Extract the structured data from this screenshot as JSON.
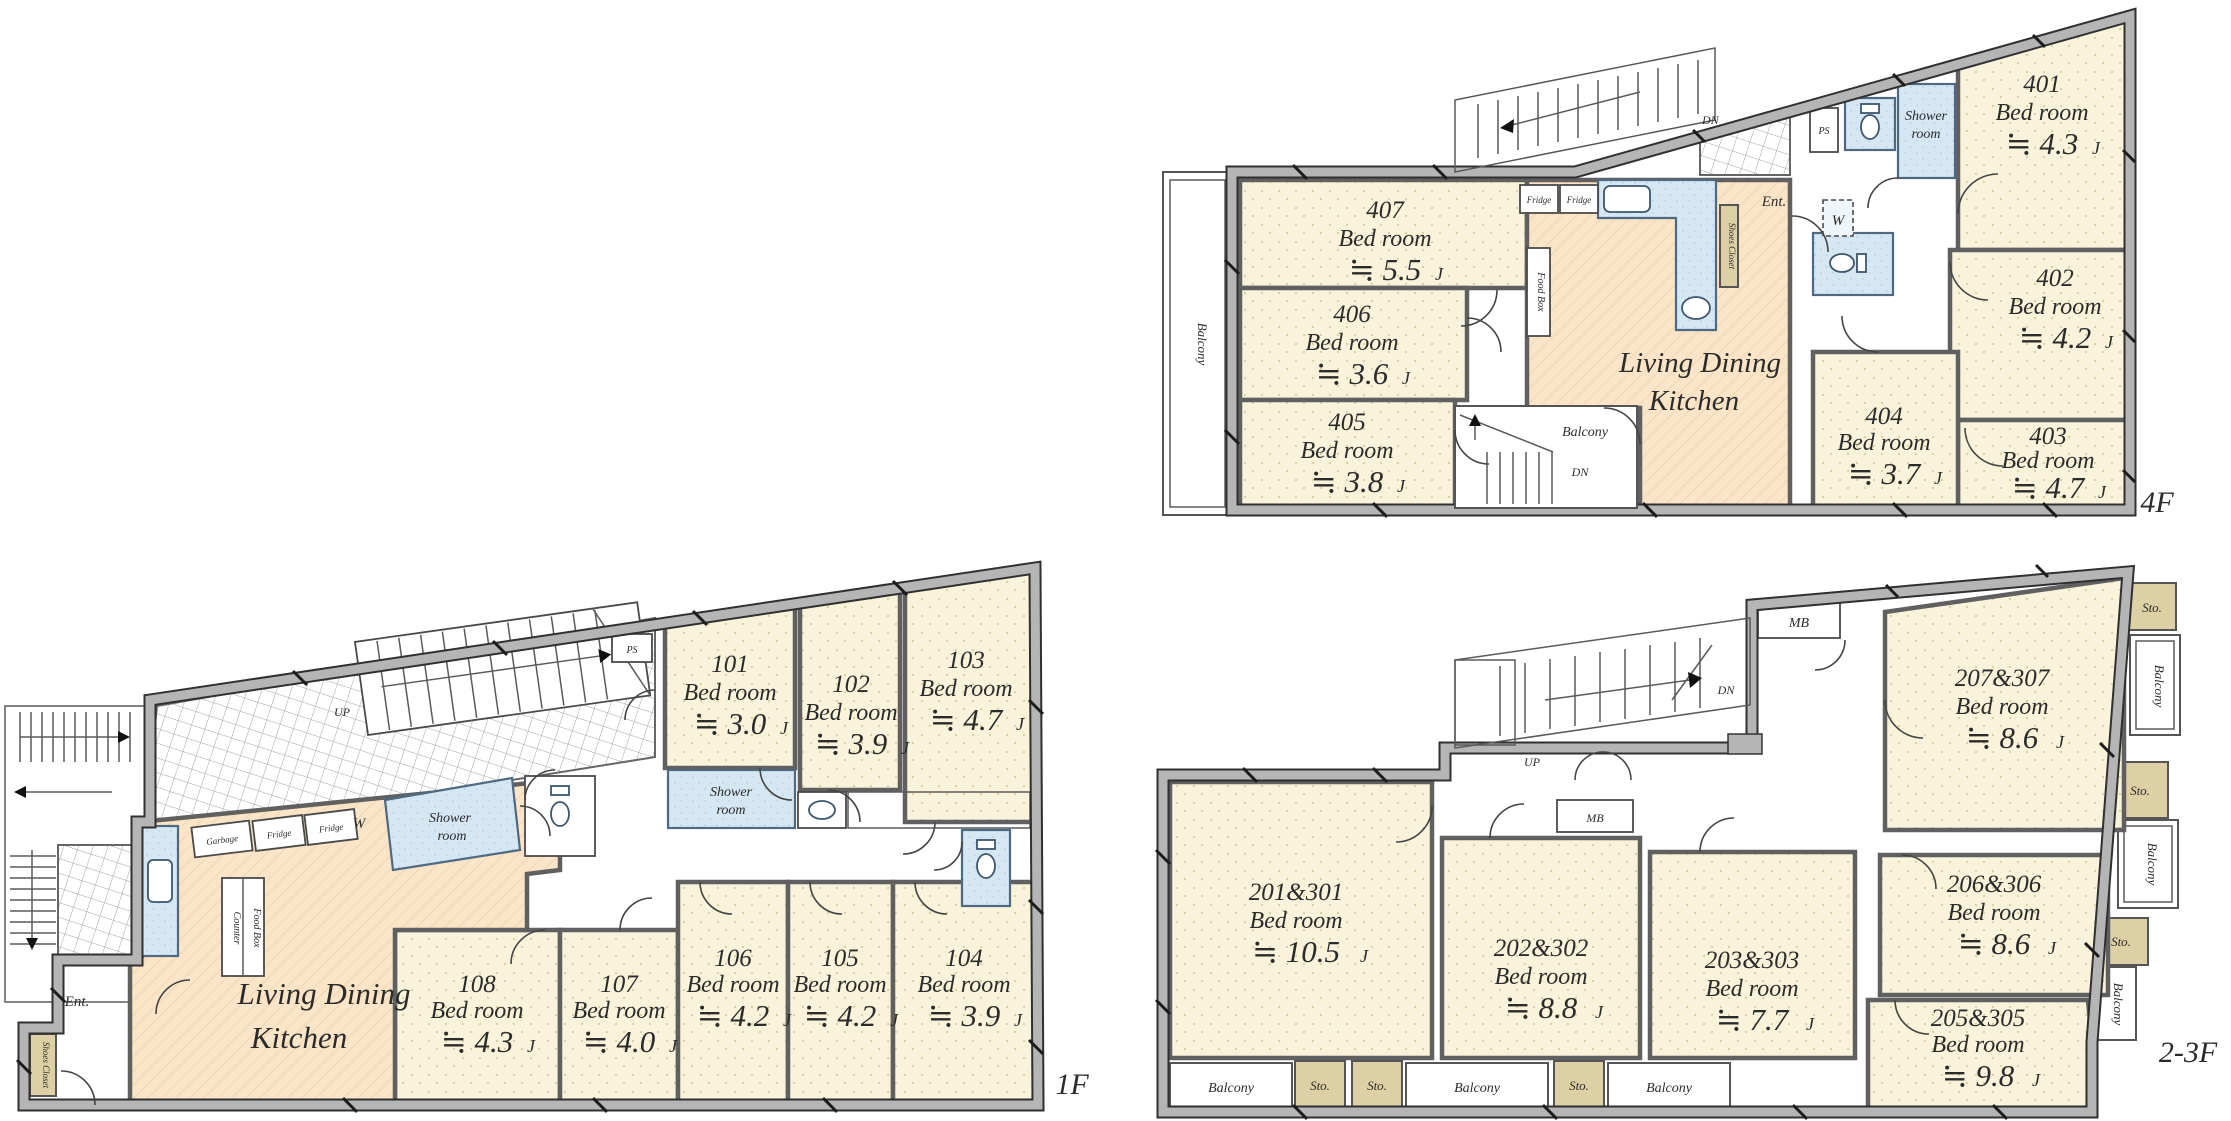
{
  "labels": {
    "balcony": "Balcony",
    "sto": "Sto.",
    "ent": "Ent.",
    "shower": "Shower",
    "room": "room",
    "living_dining": "Living Dining",
    "kitchen": "Kitchen",
    "up": "UP",
    "dn": "DN",
    "ps": "PS",
    "w": "W",
    "mb": "MB",
    "fridge": "Fridge",
    "garbage": "Garbage",
    "counter": "Counter",
    "food_box": "Food Box",
    "shoes_closet": "Shoes Closet"
  },
  "floors": {
    "f1": {
      "name": "1F",
      "rooms": [
        {
          "no": "101",
          "type": "Bed room",
          "area": "≒ 3.0",
          "unit": "J"
        },
        {
          "no": "102",
          "type": "Bed room",
          "area": "≒ 3.9",
          "unit": "J"
        },
        {
          "no": "103",
          "type": "Bed room",
          "area": "≒ 4.7",
          "unit": "J"
        },
        {
          "no": "104",
          "type": "Bed room",
          "area": "≒ 3.9",
          "unit": "J"
        },
        {
          "no": "105",
          "type": "Bed room",
          "area": "≒ 4.2",
          "unit": "J"
        },
        {
          "no": "106",
          "type": "Bed room",
          "area": "≒ 4.2",
          "unit": "J"
        },
        {
          "no": "107",
          "type": "Bed room",
          "area": "≒ 4.0",
          "unit": "J"
        },
        {
          "no": "108",
          "type": "Bed room",
          "area": "≒ 4.3",
          "unit": "J"
        }
      ]
    },
    "f23": {
      "name": "2-3F",
      "rooms": [
        {
          "no": "201&301",
          "type": "Bed room",
          "area": "≒ 10.5",
          "unit": "J"
        },
        {
          "no": "202&302",
          "type": "Bed room",
          "area": "≒ 8.8",
          "unit": "J"
        },
        {
          "no": "203&303",
          "type": "Bed room",
          "area": "≒ 7.7",
          "unit": "J"
        },
        {
          "no": "205&305",
          "type": "Bed room",
          "area": "≒ 9.8",
          "unit": "J"
        },
        {
          "no": "206&306",
          "type": "Bed room",
          "area": "≒ 8.6",
          "unit": "J"
        },
        {
          "no": "207&307",
          "type": "Bed room",
          "area": "≒ 8.6",
          "unit": "J"
        }
      ]
    },
    "f4": {
      "name": "4F",
      "rooms": [
        {
          "no": "401",
          "type": "Bed room",
          "area": "≒ 4.3",
          "unit": "J"
        },
        {
          "no": "402",
          "type": "Bed room",
          "area": "≒ 4.2",
          "unit": "J"
        },
        {
          "no": "403",
          "type": "Bed room",
          "area": "≒ 4.7",
          "unit": "J"
        },
        {
          "no": "404",
          "type": "Bed room",
          "area": "≒ 3.7",
          "unit": "J"
        },
        {
          "no": "405",
          "type": "Bed room",
          "area": "≒ 3.8",
          "unit": "J"
        },
        {
          "no": "406",
          "type": "Bed room",
          "area": "≒ 3.6",
          "unit": "J"
        },
        {
          "no": "407",
          "type": "Bed room",
          "area": "≒ 5.5",
          "unit": "J"
        }
      ]
    }
  },
  "colors": {
    "bedroom_fill": "#f8f3da",
    "ldk_fill": "#fae5c8",
    "wet_fill": "#d6e7f4",
    "storage_fill": "#ddd0a4",
    "wall_gray": "#b5b5b5"
  }
}
